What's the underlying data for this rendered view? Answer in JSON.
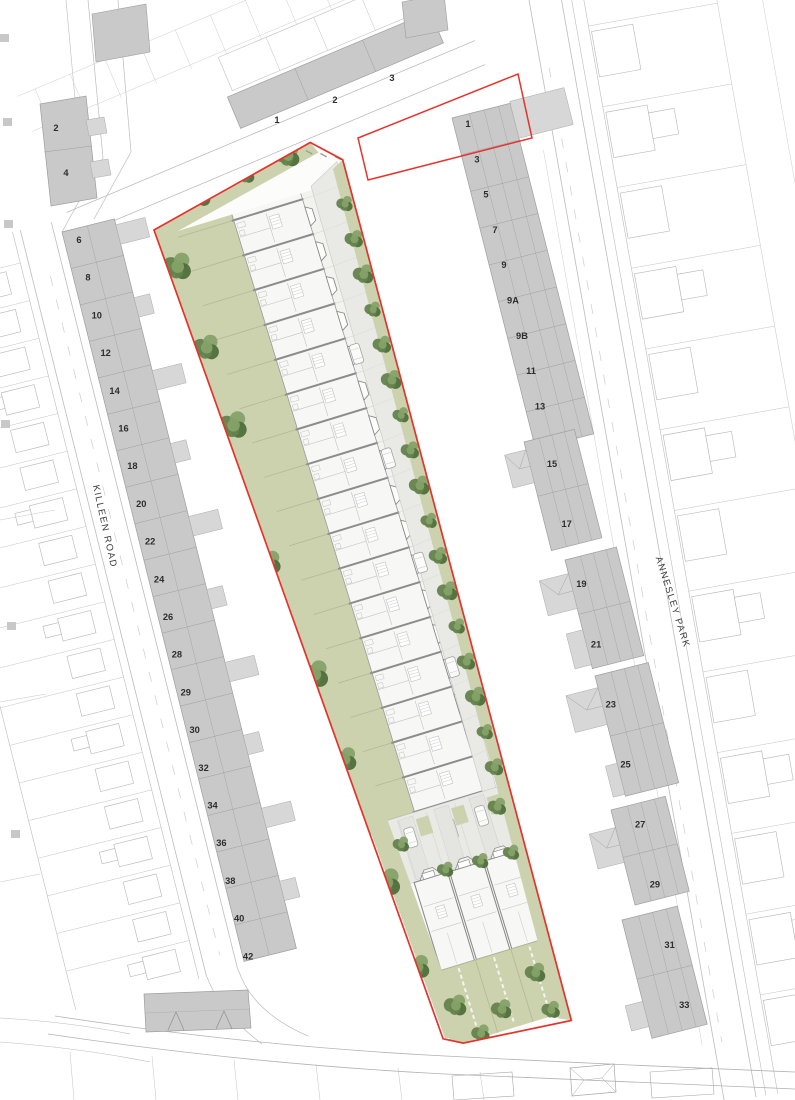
{
  "streets": {
    "killeen": {
      "name": "KILLEEN ROAD"
    },
    "annesley": {
      "name": "ANNESLEY PARK"
    }
  },
  "plots": {
    "killeen_side": [
      "2",
      "4",
      "6",
      "8",
      "10",
      "12",
      "14",
      "16",
      "18",
      "20",
      "22",
      "24",
      "26",
      "28",
      "29",
      "30",
      "32",
      "34",
      "36",
      "38",
      "40",
      "42"
    ],
    "annesley_side_upper": [
      "1",
      "3",
      "5",
      "7",
      "9",
      "9A",
      "9B",
      "11",
      "13"
    ],
    "annesley_side_lower": [
      "15",
      "17",
      "19",
      "21",
      "23",
      "25",
      "27",
      "29",
      "31",
      "33"
    ],
    "top_street": [
      "1",
      "2",
      "3"
    ]
  },
  "colors": {
    "boundary_red": "#e5332b",
    "existing_building_gray": "#c9c9c9",
    "extension_gray": "#d7d7d7",
    "garden_green": "#ccd2ae",
    "garden_line_green": "#b1b893",
    "tree_green": "#64834c",
    "tree_green_dark": "#4f6e3c",
    "tree_green_light": "#85a168",
    "road_gray": "#e9e9e6",
    "plan_fill": "#f7f7f5",
    "wall_gray": "#8c8c8c",
    "parcel_line_gray": "#bcbcbc",
    "label_text": "#2d2d2d"
  }
}
